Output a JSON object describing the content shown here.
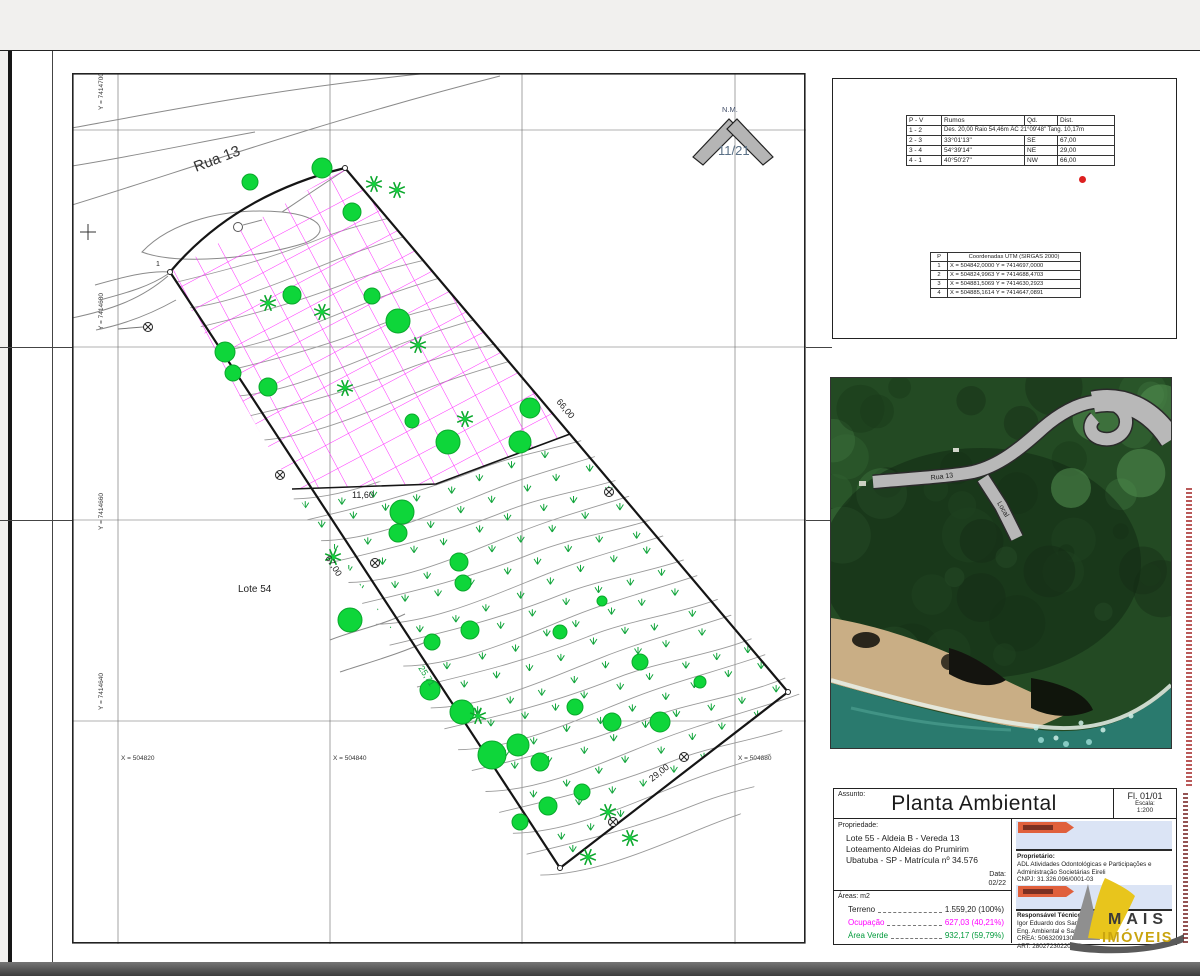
{
  "sheet": {
    "assunto_label": "Assunto:",
    "title": "Planta Ambiental",
    "folha": "Fl. 01/01",
    "escala_label": "Escala:",
    "escala": "1:200"
  },
  "propriedade": {
    "label": "Propriedade:",
    "lines": [
      "Lote 55 - Aldeia B - Vereda 13",
      "Loteamento Aldeias do Prumirim",
      "Ubatuba - SP - Matrícula nº 34.576"
    ],
    "data_label": "Data:",
    "data": "02/22"
  },
  "areas": {
    "label": "Áreas: m2",
    "rows": [
      {
        "label": "Terreno",
        "value": "1.559,20  (100%)",
        "color": "#222222"
      },
      {
        "label": "Ocupação",
        "value": "627,03 (40,21%)",
        "color": "#ff00ff"
      },
      {
        "label": "Área Verde",
        "value": "932,17 (59,79%)",
        "color": "#009a3a"
      }
    ]
  },
  "proprietario": {
    "label": "Proprietário:",
    "lines": [
      "ADL Atividades Odontológicas e Participações e",
      "Administração Societárias Eireli",
      "CNPJ: 31.326.096/0001-03"
    ]
  },
  "responsavel": {
    "label": "Responsável Técnico:",
    "lines": [
      "Igor Eduardo dos Santos de Fafa",
      "Eng. Ambiental e Sanit.",
      "CREA: 5063209130",
      "ART: 28027230220302"
    ]
  },
  "survey_table": {
    "headers": [
      "P - V",
      "Rumos",
      "Qd.",
      "Dist."
    ],
    "arc_row": [
      "1 - 2",
      "Des. 20,00 Raio 54,46m ÂC 21°09'48\" Tang. 10,17m"
    ],
    "rows": [
      [
        "2 - 3",
        "33°01'13\"",
        "SE",
        "67,00"
      ],
      [
        "3 - 4",
        "54°39'14\"",
        "NE",
        "29,00"
      ],
      [
        "4 - 1",
        "40°50'27\"",
        "NW",
        "66,00"
      ]
    ]
  },
  "coords_table": {
    "p_header": "P",
    "header": "Coordenadas UTM (SIRGAS 2000)",
    "rows": [
      [
        "1",
        "X = 504842,0000   Y = 7414697,0000"
      ],
      [
        "2",
        "X = 504824,9963   Y = 7414688,4703"
      ],
      [
        "3",
        "X = 504881,5069   Y = 7414630,2923"
      ],
      [
        "4",
        "X = 504885,1614   Y = 7414647,0891"
      ]
    ]
  },
  "plan": {
    "street": "Rua 13",
    "lote": "Lote 54",
    "vertex": "1",
    "north_label": "N.M.",
    "north_value": "11/21",
    "grid_y": [
      "Y = 7414700",
      "Y = 7414680",
      "Y = 7414660",
      "Y = 7414640"
    ],
    "grid_x": [
      "X = 504820",
      "X = 504840",
      "X = 504880"
    ],
    "dims": {
      "ne": "66,00",
      "sw": "67,00",
      "se": "29,00",
      "inner": "11,60",
      "green": "25,71"
    },
    "colors": {
      "hatch": "#ff2bff",
      "tree": "#0ed63a",
      "tree_edge": "#0aa82c",
      "grass": "#12a53c",
      "contour": "#9a9a9a",
      "boundary": "#151515"
    },
    "trees": [
      [
        250,
        182,
        8
      ],
      [
        322,
        168,
        10
      ],
      [
        352,
        212,
        9
      ],
      [
        292,
        295,
        9
      ],
      [
        372,
        296,
        8
      ],
      [
        398,
        321,
        12
      ],
      [
        225,
        352,
        10
      ],
      [
        233,
        373,
        8
      ],
      [
        268,
        387,
        9
      ],
      [
        412,
        421,
        7
      ],
      [
        448,
        442,
        12
      ],
      [
        530,
        408,
        10
      ],
      [
        402,
        512,
        12
      ],
      [
        398,
        533,
        9
      ],
      [
        459,
        562,
        9
      ],
      [
        463,
        583,
        8
      ],
      [
        520,
        442,
        11
      ],
      [
        350,
        620,
        12
      ],
      [
        470,
        630,
        9
      ],
      [
        432,
        642,
        8
      ],
      [
        560,
        632,
        7
      ],
      [
        602,
        601,
        5
      ],
      [
        640,
        662,
        8
      ],
      [
        430,
        690,
        10
      ],
      [
        462,
        712,
        12
      ],
      [
        492,
        755,
        14
      ],
      [
        518,
        745,
        11
      ],
      [
        540,
        762,
        9
      ],
      [
        575,
        707,
        8
      ],
      [
        612,
        722,
        9
      ],
      [
        660,
        722,
        10
      ],
      [
        582,
        792,
        8
      ],
      [
        548,
        806,
        9
      ],
      [
        520,
        822,
        8
      ],
      [
        700,
        682,
        6
      ]
    ],
    "palms": [
      [
        374,
        184
      ],
      [
        397,
        190
      ],
      [
        268,
        303
      ],
      [
        322,
        312
      ],
      [
        418,
        345
      ],
      [
        345,
        388
      ],
      [
        465,
        419
      ],
      [
        333,
        557
      ],
      [
        478,
        716
      ],
      [
        608,
        812
      ],
      [
        630,
        838
      ],
      [
        588,
        857
      ]
    ],
    "survey_points": [
      [
        148,
        327
      ],
      [
        280,
        475
      ],
      [
        375,
        563
      ],
      [
        609,
        492
      ],
      [
        684,
        757
      ],
      [
        613,
        822
      ]
    ]
  },
  "photo": {
    "road_label": "Rua 13",
    "local_label": "Local"
  },
  "logo": {
    "line1": "MAIS",
    "line2": "IMÓVEIS"
  }
}
